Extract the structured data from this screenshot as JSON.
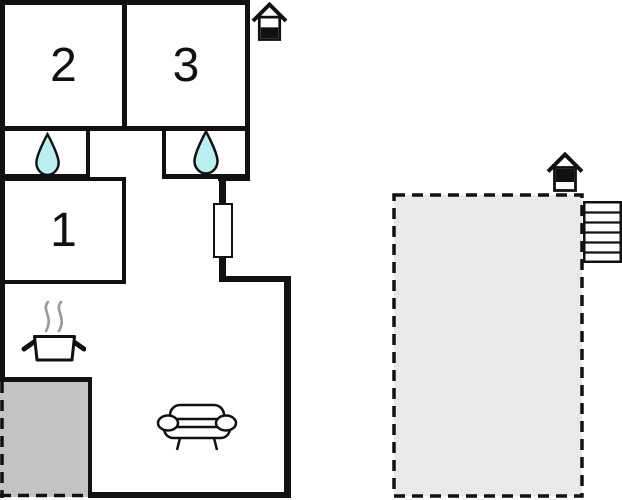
{
  "floorplan": {
    "type": "vacation-home-floor-plan",
    "rooms": [
      {
        "name": "bedroom-1",
        "label": "1"
      },
      {
        "name": "bedroom-2",
        "label": "2"
      },
      {
        "name": "bedroom-3",
        "label": "3"
      }
    ],
    "icons": [
      {
        "name": "entrance-house-icon-top",
        "meaning": "entrance"
      },
      {
        "name": "entrance-house-icon-terrace",
        "meaning": "entrance"
      },
      {
        "name": "water-drop-icon-left-bathroom",
        "meaning": "bathroom/water"
      },
      {
        "name": "water-drop-icon-right-bathroom",
        "meaning": "bathroom/water"
      },
      {
        "name": "stove-pot-icon",
        "meaning": "kitchen"
      },
      {
        "name": "sofa-icon",
        "meaning": "living room"
      },
      {
        "name": "stairs-icon",
        "meaning": "stairs to terrace"
      }
    ],
    "areas": [
      {
        "name": "terrace-bottom-left",
        "style": "solid-gray-dashed-edge"
      },
      {
        "name": "terrace-right",
        "style": "light-gray-dashed-outline"
      }
    ],
    "colors": {
      "wall": "#111111",
      "water_drop": "#b8f0f2",
      "terrace_left": "#c3c3c3",
      "terrace_right": "#e9e9e9",
      "steam": "#999999",
      "window": "#ffffff",
      "background": "#ffffff"
    }
  }
}
